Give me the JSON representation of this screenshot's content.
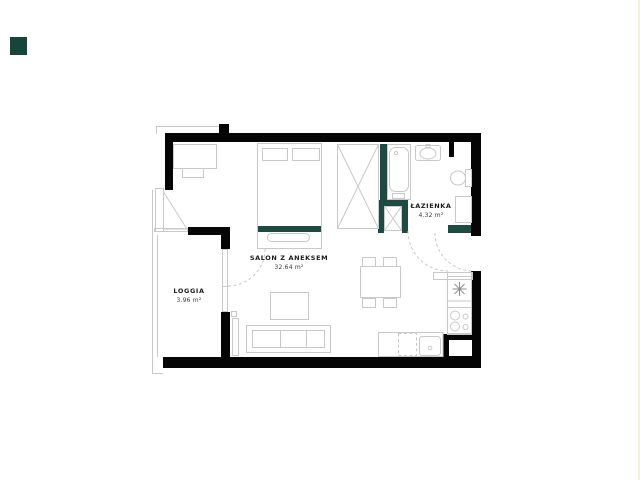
{
  "watermark": {
    "color": "#174539"
  },
  "colors": {
    "background": "#ffffff",
    "wall": "#050505",
    "accent": "#1d4b41",
    "line": "#c9c9c9",
    "linedark": "#8f8f8f",
    "text": "#1c1c1c",
    "subtext": "#3c3c3c",
    "edge": "#f7efdd"
  },
  "rooms": {
    "salon": {
      "name": "SALON Z ANEKSEM",
      "area": "32.64 m²"
    },
    "bathroom": {
      "name": "ŁAZIENKA",
      "area": "4.32 m²"
    },
    "loggia": {
      "name": "LOGGIA",
      "area": "3.96 m²"
    }
  }
}
